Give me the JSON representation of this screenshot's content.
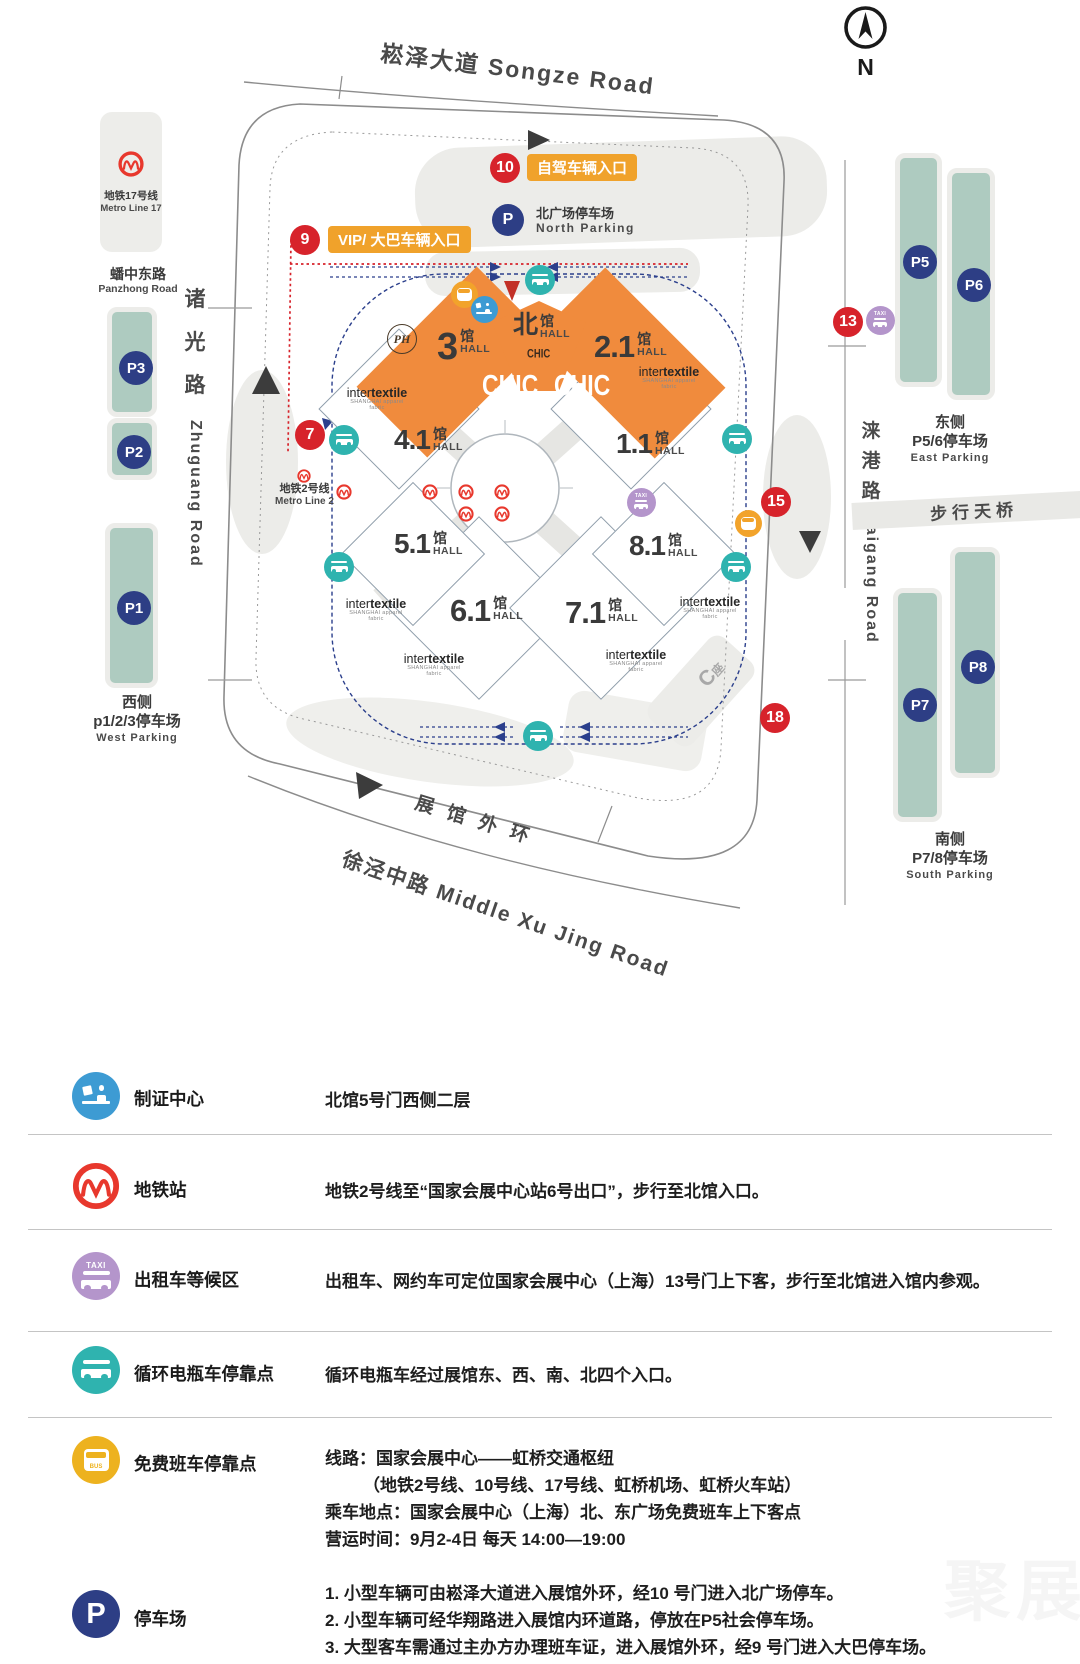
{
  "map": {
    "songze_road": "崧泽大道 Songze Road",
    "compass_n": "N",
    "metro17_box": {
      "cn": "地铁17号线",
      "en": "Metro Line 17"
    },
    "panzhong": {
      "cn": "蟠中东路",
      "en": "Panzhong Road"
    },
    "zhuguang": {
      "c1": "诸",
      "c2": "光",
      "c3": "路",
      "en": "Zhuguang Road"
    },
    "xumin": {
      "cn": "徐民路",
      "en": "Xumin Road"
    },
    "metro2": {
      "cn": "地铁2号线",
      "en": "Metro Line 2"
    },
    "laigang": {
      "c1": "涞",
      "c2": "港",
      "c3": "路",
      "en": "Laigang Road"
    },
    "footbridge": "步行天桥",
    "outer_ring_road": "展馆外环",
    "xujing_road": "徐泾中路  Middle Xu Jing Road",
    "c_block": {
      "c": "C",
      "zuo": "座"
    },
    "north_parking": {
      "p": "P",
      "cn": "北广场停车场",
      "en": "North Parking"
    },
    "entrance_self": "自驾车辆入口",
    "entrance_vip": "VIP/ 大巴车辆入口",
    "markers": {
      "g7": "7",
      "g9": "9",
      "g10": "10",
      "g13": "13",
      "g15": "15",
      "g18": "18"
    },
    "lots": {
      "p1": "P1",
      "p2": "P2",
      "p3": "P3",
      "p5": "P5",
      "p6": "P6",
      "p7": "P7",
      "p8": "P8"
    },
    "west_parking": {
      "side": "西侧",
      "name": "p1/2/3停车场",
      "en": "West Parking"
    },
    "east_parking": {
      "side": "东侧",
      "name": "P5/6停车场",
      "en": "East Parking"
    },
    "south_parking": {
      "side": "南侧",
      "name": "P7/8停车场",
      "en": "South Parking"
    },
    "halls": {
      "h3": {
        "num": "3",
        "guan": "馆",
        "hall": "HALL"
      },
      "h21": {
        "num": "2.1",
        "guan": "馆",
        "hall": "HALL"
      },
      "hn": {
        "num": "北",
        "guan": "馆",
        "hall": "HALL"
      },
      "h41": {
        "num": "4.1",
        "guan": "馆",
        "hall": "HALL"
      },
      "h11": {
        "num": "1.1",
        "guan": "馆",
        "hall": "HALL"
      },
      "h51": {
        "num": "5.1",
        "guan": "馆",
        "hall": "HALL"
      },
      "h81": {
        "num": "8.1",
        "guan": "馆",
        "hall": "HALL"
      },
      "h61": {
        "num": "6.1",
        "guan": "馆",
        "hall": "HALL"
      },
      "h71": {
        "num": "7.1",
        "guan": "馆",
        "hall": "HALL"
      }
    },
    "brands": {
      "chic": "CHIC",
      "inter": "inter",
      "textile": "textile",
      "itx_sub": "SHANGHAI apparel fabric",
      "ph": "PH"
    },
    "taxi_text": "TAXI"
  },
  "legend": {
    "parking_p": "P",
    "taxi_text": "TAXI",
    "bus_text": "BUS",
    "rows": [
      {
        "icon": "badge-icon",
        "label": "制证中心",
        "lines": [
          "北馆5号门西侧二层"
        ]
      },
      {
        "icon": "metro-icon",
        "label": "地铁站",
        "lines": [
          "地铁2号线至“国家会展中心站6号出口”，步行至北馆入口。"
        ]
      },
      {
        "icon": "taxi-icon",
        "label": "出租车等候区",
        "lines": [
          "出租车、网约车可定位国家会展中心（上海）13号门上下客，步行至北馆进入馆内参观。"
        ]
      },
      {
        "icon": "shuttle-icon",
        "label": "循环电瓶车停靠点",
        "lines": [
          "循环电瓶车经过展馆东、西、南、北四个入口。"
        ]
      },
      {
        "icon": "bus-icon",
        "label": "免费班车停靠点",
        "lines": [
          "线路：国家会展中心——虹桥交通枢纽",
          "（地铁2号线、10号线、17号线、虹桥机场、虹桥火车站）",
          "乘车地点：国家会展中心（上海）北、东广场免费班车上下客点",
          "营运时间：9月2-4日 每天 14:00—19:00"
        ]
      },
      {
        "icon": "parking-icon",
        "label": "停车场",
        "lines": [
          "1. 小型车辆可由崧泽大道进入展馆外环，经10 号门进入北广场停车。",
          "2. 小型车辆可经华翔路进入展馆内环道路，停放在P5社会停车场。",
          "3. 大型客车需通过主办方办理班车证，进入展馆外环，经9 号门进入大巴停车场。"
        ]
      }
    ]
  },
  "watermark": "聚展",
  "colors": {
    "hall_orange": "#F08B3D",
    "parking_green": "#AECBC0",
    "navy": "#2D3E85",
    "marker_red": "#D7232B",
    "shuttle_teal": "#2FB3AF",
    "taxi_purple": "#B495CB",
    "bus_orange": "#F2A32B",
    "bus_yellow": "#EDB21F",
    "cert_blue": "#3D9BD3",
    "metro_red": "#E8382D"
  }
}
